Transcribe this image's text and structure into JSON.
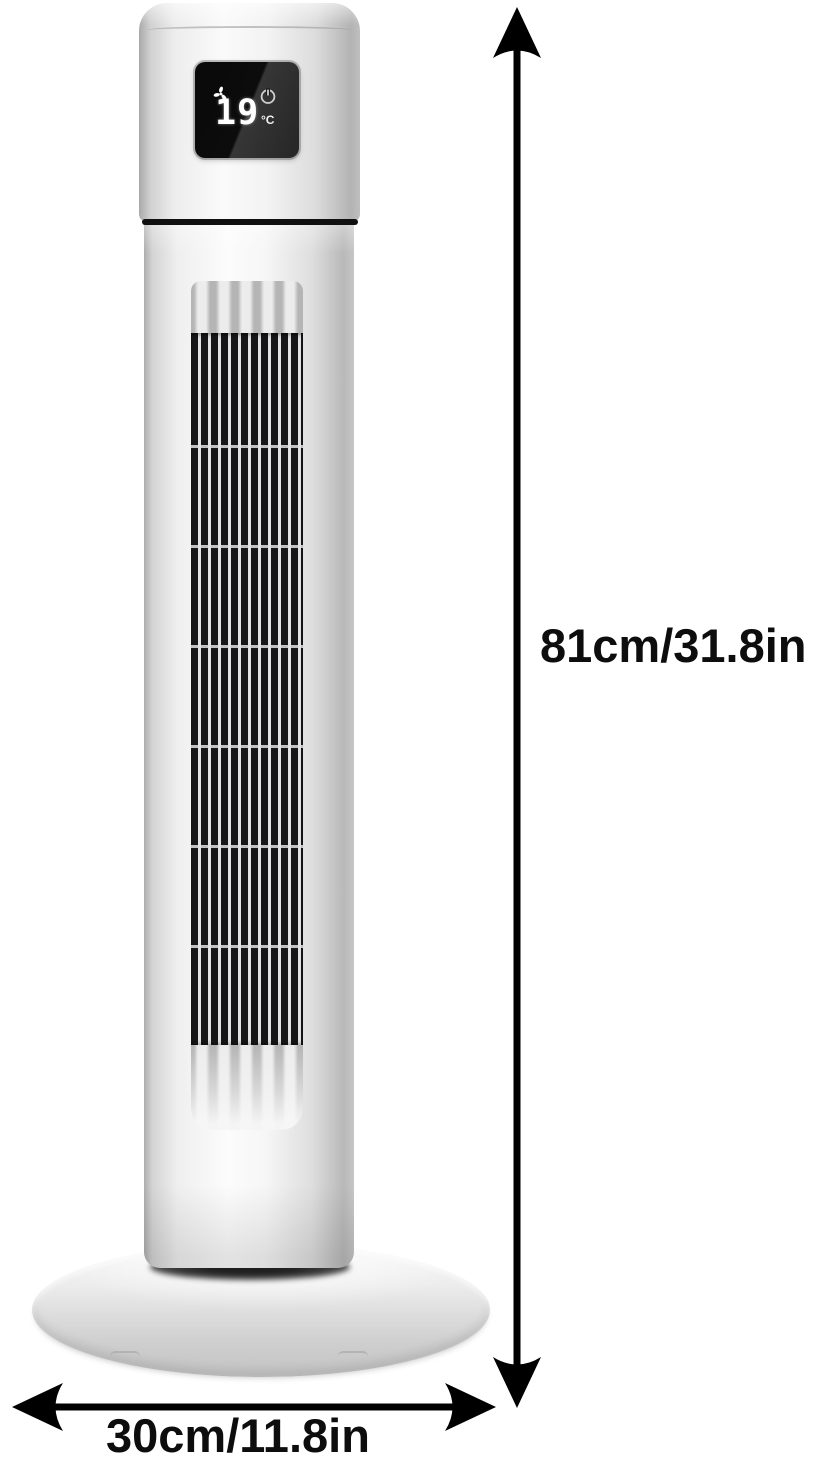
{
  "display": {
    "temperature": "19",
    "unit": "°C"
  },
  "dimensions": {
    "height": "81cm/31.8in",
    "width": "30cm/11.8in"
  },
  "icons": {
    "fan": "fan-speed-icon",
    "power": "power-icon"
  },
  "colors": {
    "background": "#ffffff",
    "body_silver": "#ededed",
    "band_black": "#101010",
    "display_bg": "#0b0b0b",
    "display_text": "#ffffff",
    "grille_slot": "#161618",
    "base_gray": "#d6d6d6",
    "arrow_and_text": "#000000"
  }
}
